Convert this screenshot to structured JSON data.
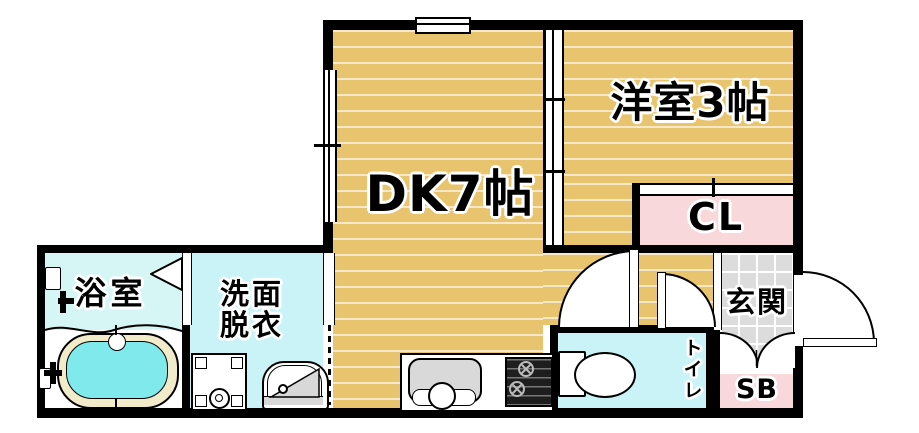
{
  "floorplan": {
    "rooms": {
      "dk": {
        "label": "DK7帖"
      },
      "western_room": {
        "label": "洋室3帖"
      },
      "closet": {
        "label": "CL"
      },
      "bathroom": {
        "label": "浴室"
      },
      "washroom": {
        "label_line1": "洗面",
        "label_line2": "脱衣"
      },
      "toilet": {
        "label": "トイレ"
      },
      "entrance": {
        "label": "玄関"
      },
      "shoe_box": {
        "label": "SB"
      }
    },
    "colors": {
      "wood_floor": "#e9c46f",
      "wet_room_cyan": "#c9f3f6",
      "closet_pink": "#f9d8db",
      "entrance_tile": "#dcdcdc",
      "bathtub_water": "#7fe9ec",
      "bathtub_rim": "#f2ebc9",
      "wall": "#000000"
    },
    "fixtures": [
      "bathtub",
      "bath-folding-door",
      "washing-machine-pan",
      "wash-basin",
      "toilet-bowl",
      "kitchen-sink",
      "gas-stove",
      "entrance-door",
      "shoe-box-doors",
      "sliding-partition",
      "windows"
    ]
  }
}
